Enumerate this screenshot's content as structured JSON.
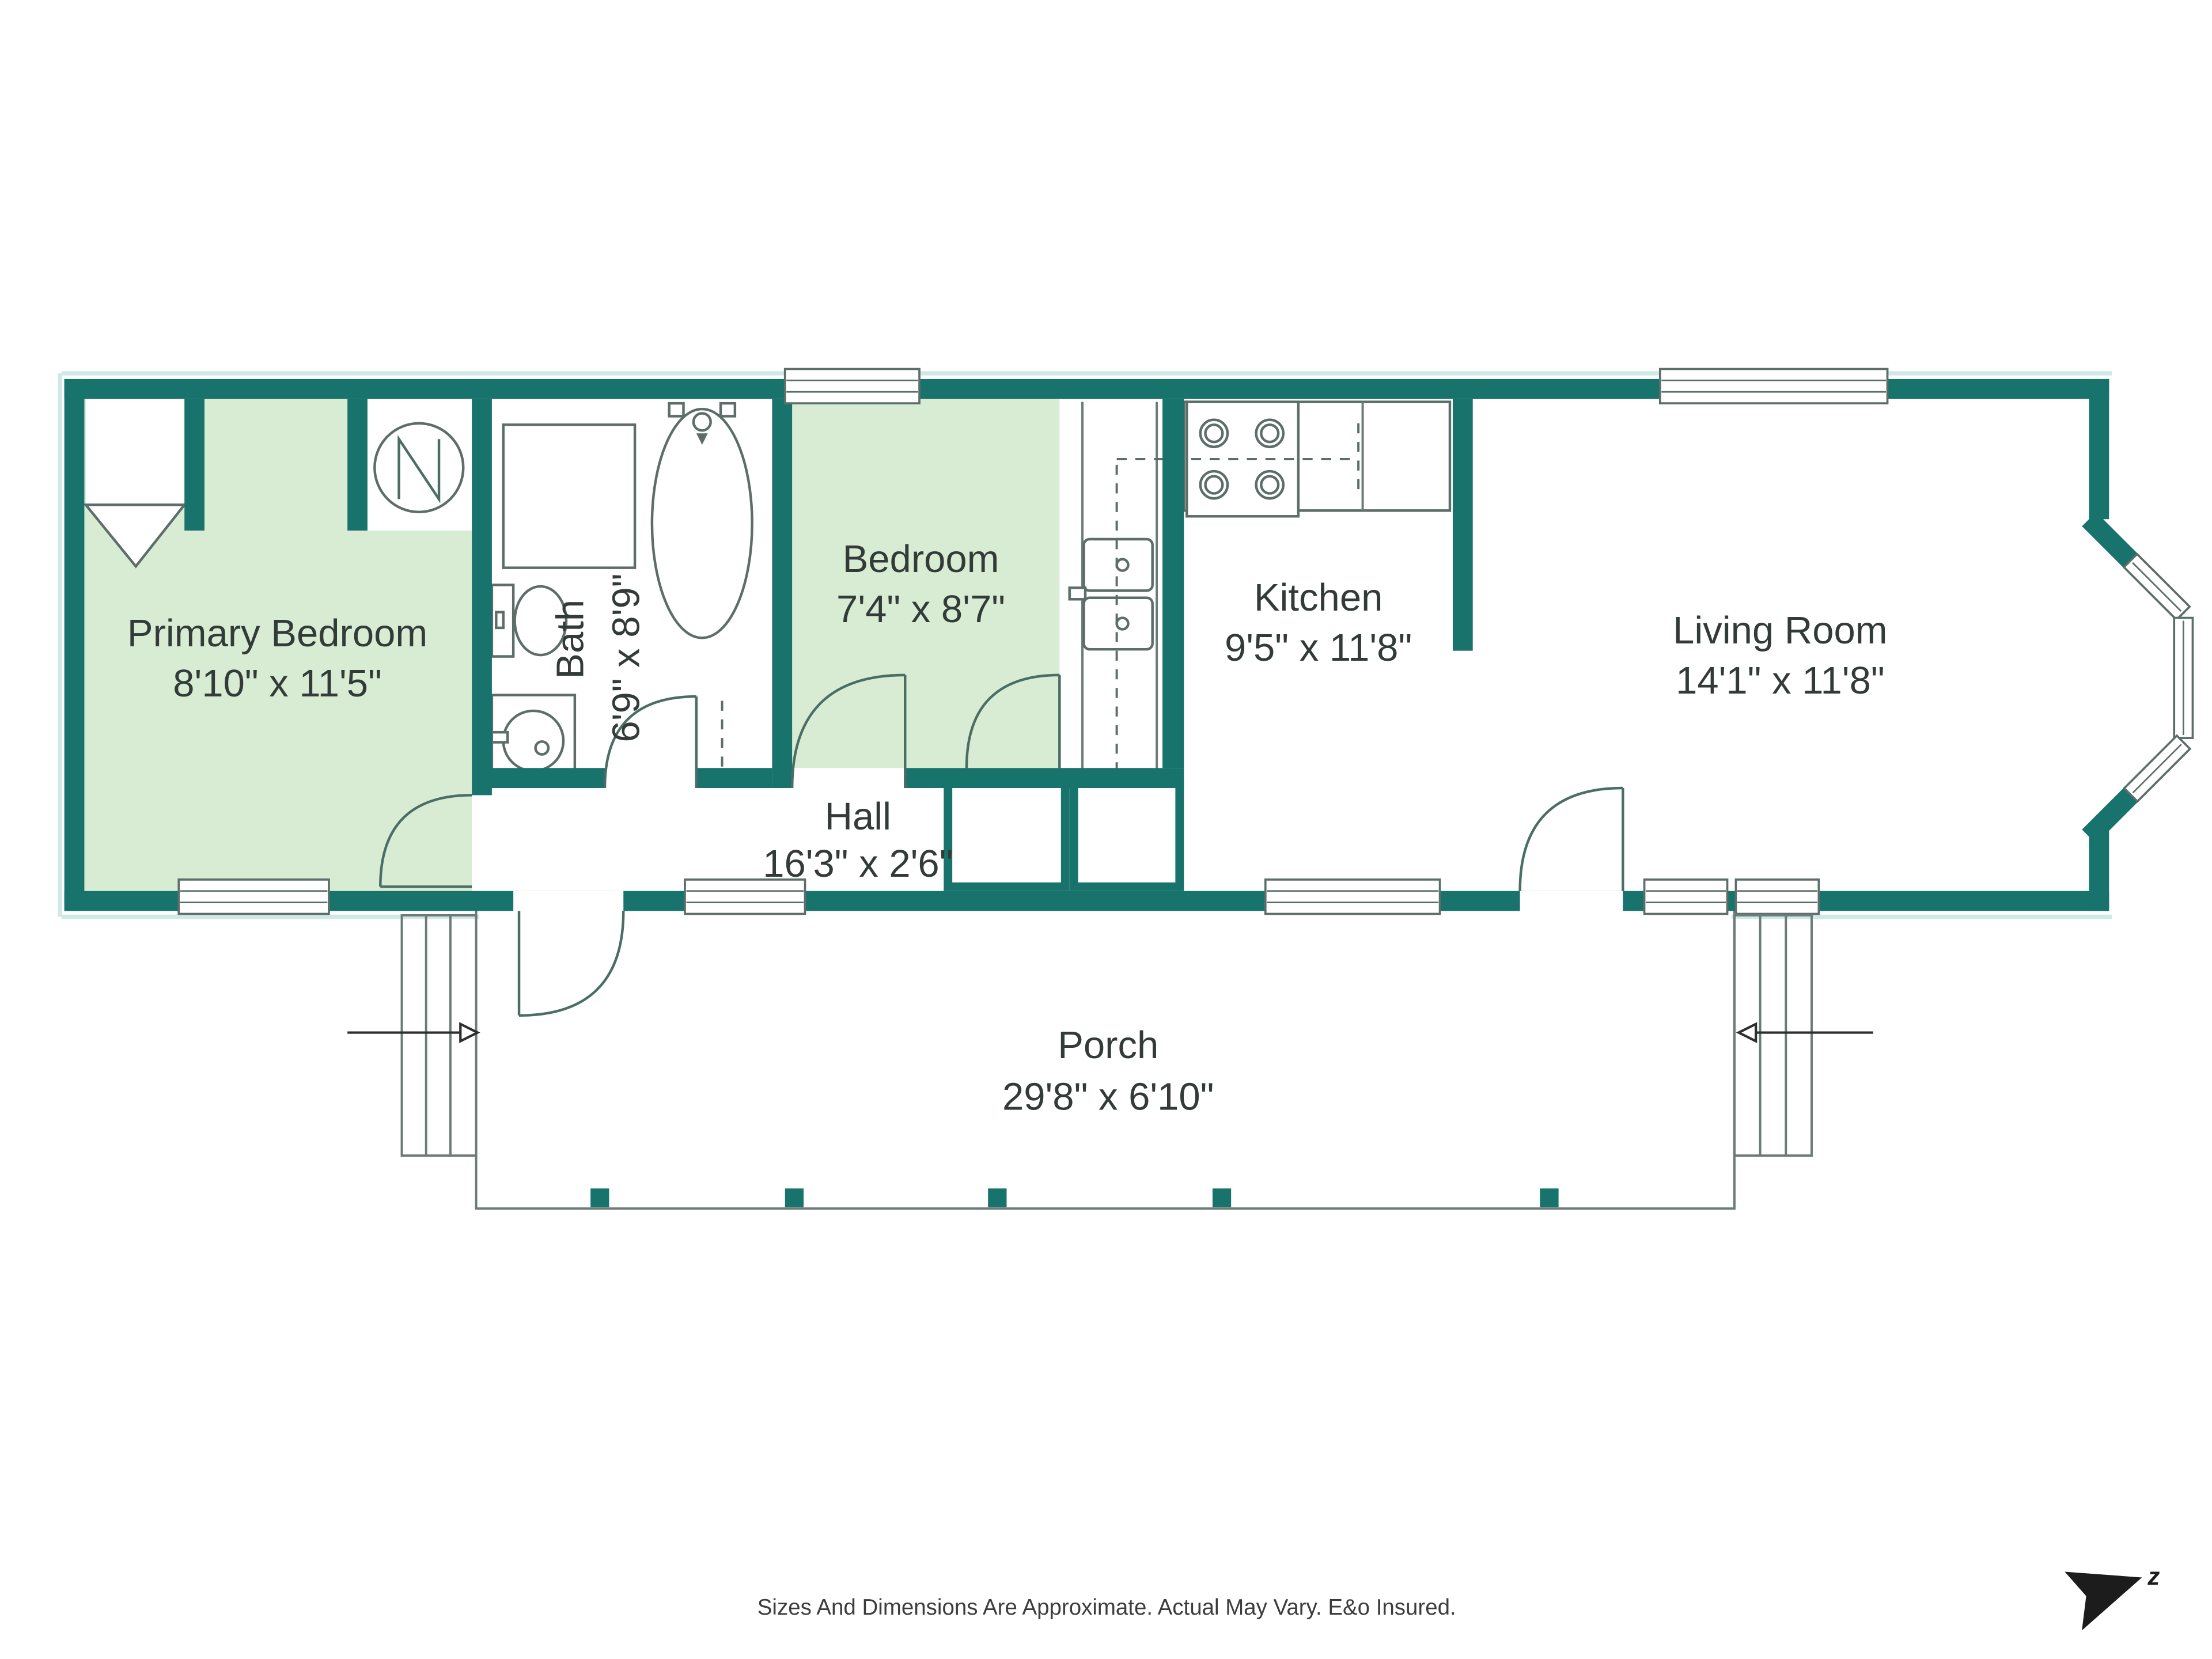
{
  "floor_plan": {
    "title": "Single-level home floor plan with porch",
    "rooms": {
      "primary_bedroom": {
        "name": "Primary Bedroom",
        "dims": "8'10\" x 11'5\""
      },
      "bath": {
        "name": "Bath",
        "dims": "6'9\" x 8'9\""
      },
      "bedroom": {
        "name": "Bedroom",
        "dims": "7'4\" x 8'7\""
      },
      "kitchen": {
        "name": "Kitchen",
        "dims": "9'5\" x 11'8\""
      },
      "living_room": {
        "name": "Living Room",
        "dims": "14'1\" x 11'8\""
      },
      "hall": {
        "name": "Hall",
        "dims": "16'3\" x 2'6\""
      },
      "porch": {
        "name": "Porch",
        "dims": "29'8\" x 6'10\""
      }
    },
    "fixtures": [
      "shower",
      "bathtub",
      "toilet",
      "vanity-sink",
      "water-heater",
      "closet-rod",
      "kitchen-sink",
      "stove",
      "refrigerator",
      "upper-cabinets-dashed",
      "stairs-left",
      "stairs-right",
      "bay-window"
    ],
    "compass": {
      "label": "z"
    },
    "footer": {
      "disclaimer": "Sizes And Dimensions Are Approximate. Actual May Vary. E&o Insured."
    },
    "colors": {
      "wall_teal": "#17736c",
      "room_green": "#d8ebd3",
      "fixture_outline": "#5d6e6a",
      "label_text": "#333b39",
      "compass_black": "#1c1c1c"
    }
  }
}
